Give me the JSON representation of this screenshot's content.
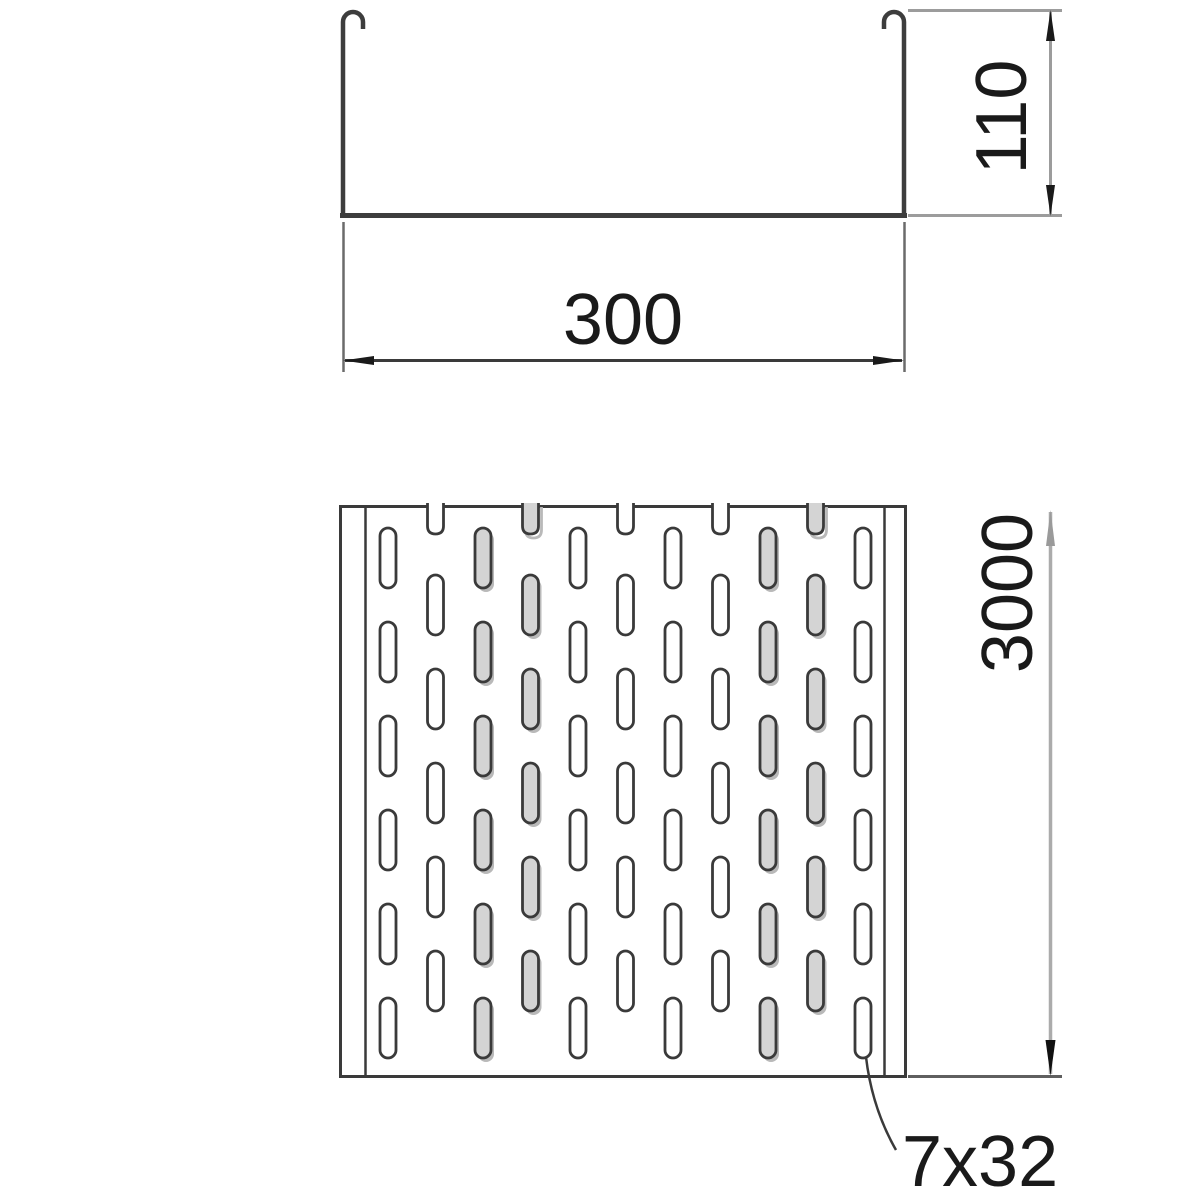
{
  "drawing": {
    "type": "cable-tray-technical-drawing",
    "dimensions": {
      "width": {
        "value": "300"
      },
      "height": {
        "value": "110"
      },
      "length": {
        "value": "3000"
      },
      "slot_size": {
        "value": "7x32"
      }
    },
    "colors": {
      "line": "#3a3a3a",
      "dim_line": "#9c9c9c",
      "ext_dark": "#5f5f5f",
      "shadow": "#b9b9b9",
      "slot_gray_fill": "#d4d4d4",
      "slot_white_fill": "#ffffff",
      "text": "#1a1a1a"
    },
    "plan_view": {
      "outer": {
        "x": 340,
        "y": 506,
        "w": 566,
        "h": 571
      },
      "rail_inner_left_x": 365.5,
      "rail_inner_right_x": 884.5,
      "pattern": {
        "first_col_x": 388,
        "col_pitch": 47.5,
        "cols": 11,
        "slot_w": 16,
        "slot_h": 60,
        "rx": 8,
        "odd_row_start": 528,
        "even_row_start": 575,
        "row_pitch": 94,
        "odd_rows": 6,
        "even_rows": 5,
        "notch_cols": [
          1,
          3,
          5,
          7,
          9
        ],
        "gray_cols": [
          2,
          3,
          8,
          9
        ],
        "notch_bottom_y": 534,
        "top_edge": 506,
        "shadow_dx": 3,
        "shadow_dy": 4,
        "slot_stroke_w": 2.8
      }
    }
  }
}
